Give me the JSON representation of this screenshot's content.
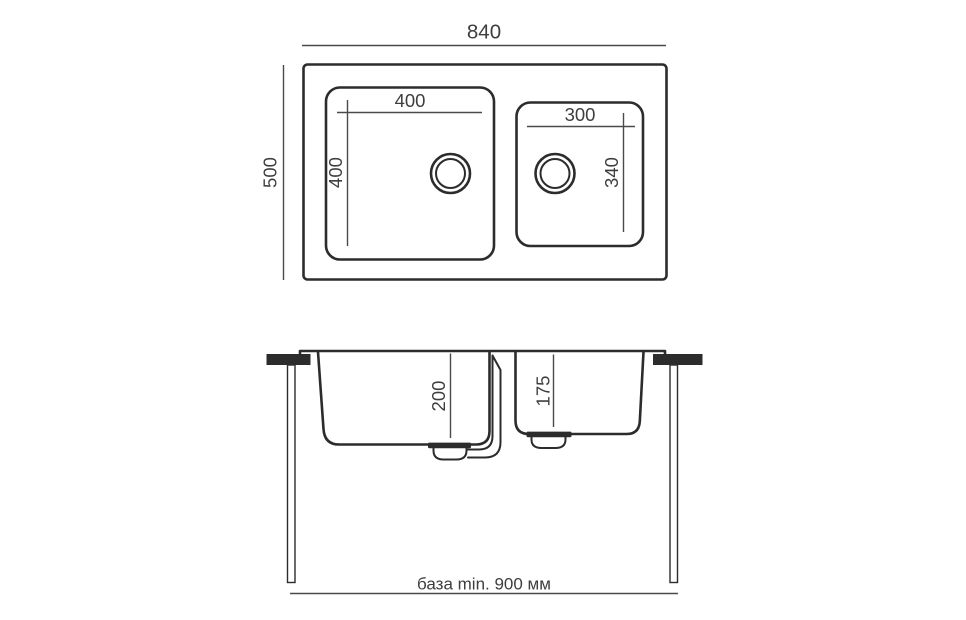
{
  "drawing": {
    "type": "sink-technical-drawing",
    "plan_view": {
      "overall_width_mm": "840",
      "overall_depth_mm": "500",
      "main_bowl": {
        "width_mm": "400",
        "depth_mm": "400"
      },
      "second_bowl": {
        "width_mm": "300",
        "depth_mm": "340"
      }
    },
    "section_view": {
      "main_bowl_height_mm": "200",
      "second_bowl_height_mm": "175",
      "base_note": "база min. 900 мм"
    },
    "colors": {
      "background": "#ffffff",
      "outline": "#2c2c2c",
      "dimension_line": "#4a4a4a",
      "text": "#3e3e3e"
    }
  }
}
